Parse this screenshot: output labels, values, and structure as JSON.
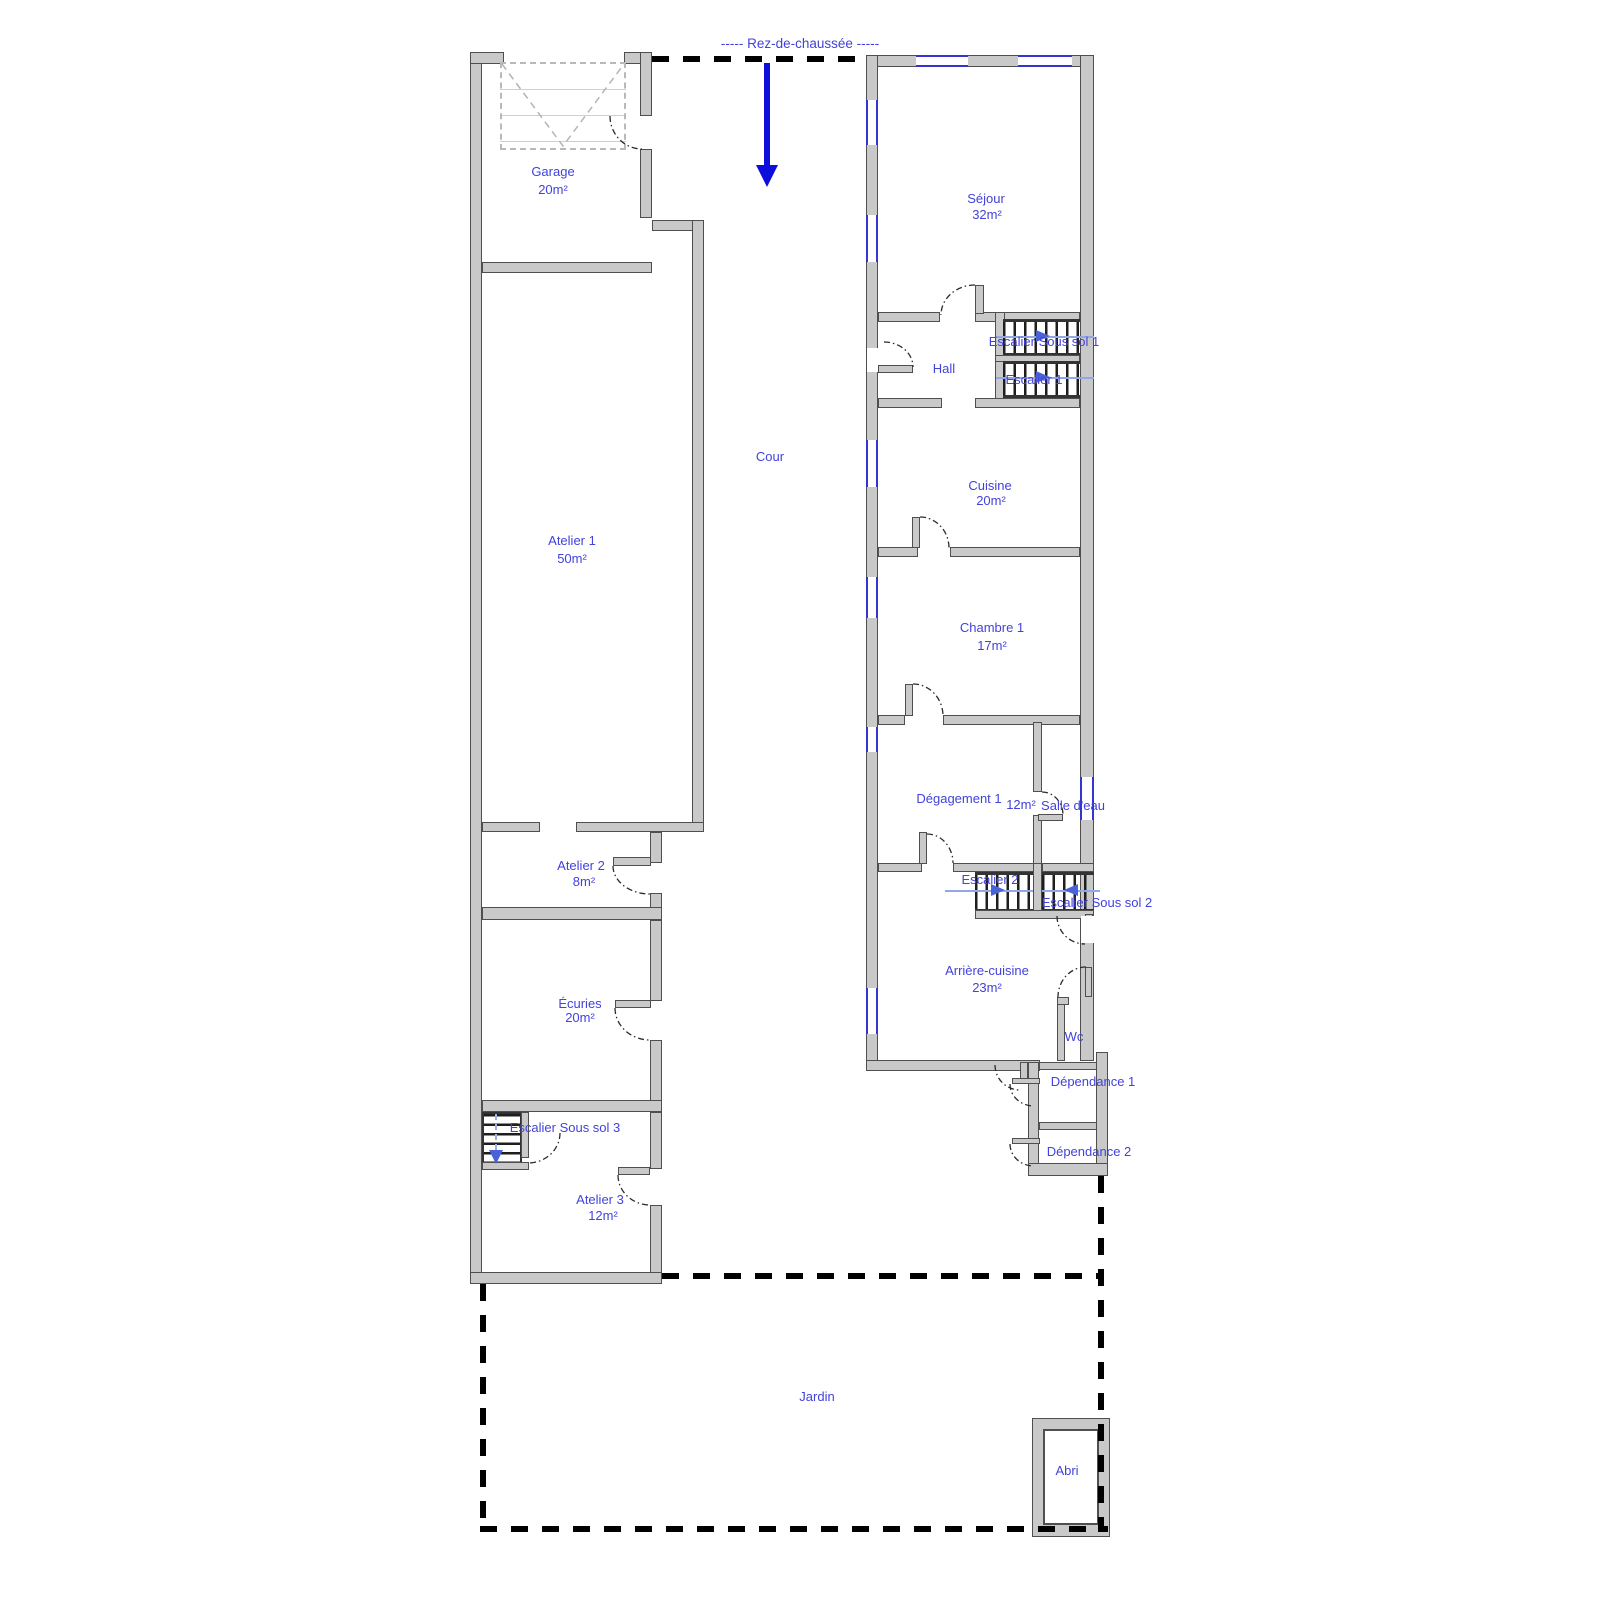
{
  "title": "-----  Rez-de-chaussée  -----",
  "colors": {
    "label_blue": "#4242dd",
    "wall_gray": "#c9c9c9",
    "window_blue": "#3434cf",
    "arrow_blue": "#0d0ddc"
  },
  "rooms": {
    "garage": {
      "name": "Garage",
      "area": "20m²"
    },
    "atelier1": {
      "name": "Atelier 1",
      "area": "50m²"
    },
    "atelier2": {
      "name": "Atelier 2",
      "area": "8m²"
    },
    "ecuries": {
      "name": "Écuries",
      "area": "20m²"
    },
    "atelier3": {
      "name": "Atelier 3",
      "area": "12m²"
    },
    "sejour": {
      "name": "Séjour",
      "area": "32m²"
    },
    "hall": {
      "name": "Hall"
    },
    "cuisine": {
      "name": "Cuisine",
      "area": "20m²"
    },
    "chambre1": {
      "name": "Chambre 1",
      "area": "17m²"
    },
    "degagement1": {
      "name": "Dégagement 1",
      "area": "12m²"
    },
    "salle_deau": {
      "name": "Salle d'eau"
    },
    "arriere_cuisine": {
      "name": "Arrière-cuisine",
      "area": "23m²"
    },
    "wc": {
      "name": "Wc"
    },
    "dependance1": {
      "name": "Dépendance 1"
    },
    "dependance2": {
      "name": "Dépendance 2"
    },
    "cour": {
      "name": "Cour"
    },
    "jardin": {
      "name": "Jardin"
    },
    "abri": {
      "name": "Abri"
    }
  },
  "stairs": {
    "escalier1": {
      "name": "Escalier 1"
    },
    "escalier2": {
      "name": "Escalier 2"
    },
    "escalier_sous_sol_1": {
      "name": "Escalier Sous sol 1"
    },
    "escalier_sous_sol_2": {
      "name": "Escalier Sous sol 2"
    },
    "escalier_sous_sol_3": {
      "name": "Escalier Sous sol 3"
    }
  }
}
